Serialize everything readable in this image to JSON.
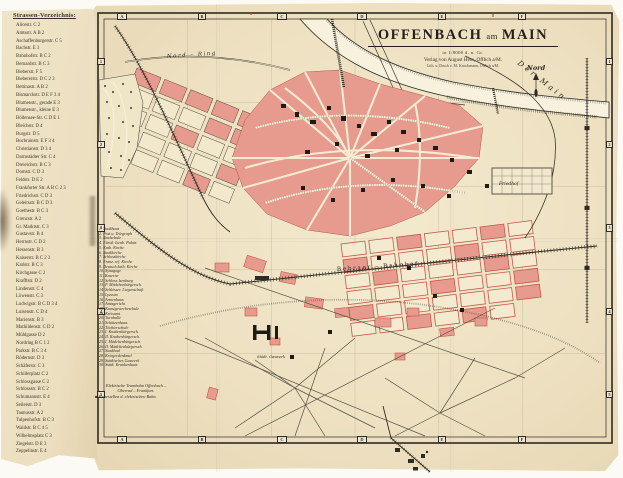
{
  "colors": {
    "paper": "#eee1c2",
    "map_ground": "#f3e9cd",
    "block_pink": "#e79a8e",
    "block_outline_red": "#c4584a",
    "ink": "#2e2a24",
    "river": "#f7f1dd"
  },
  "index": {
    "title": "Strassen-Verzeichnis:",
    "entries": [
      "Alicestr. C 2",
      "Amtsstr. A B 2",
      "Aschaffenburgerstr. C 5",
      "Bachstr. E 3",
      "Bahnhofstr. B C 2",
      "Bernardstr. B C 3",
      "Bieberstr. F 5",
      "Biebererstr. D C 2 3",
      "Bettinastr. A B 2",
      "Bismarckstr. D E F 3 4",
      "Blumenstr., gerade E 3",
      "Blumenstr., kleine E 3",
      "Böllensee-Str. C D E 1",
      "Bleichstr. D 4",
      "Burgstr. D 5",
      "Buchrainstr. E F 3 4",
      "Christianstr. D 3 4",
      "Darmstädter Str. C 4",
      "Dreieichstr. B C 3",
      "Domstr. C D 3",
      "Feldstr. D E 2",
      "Frankfurter Str. A B C 2 3",
      "Friedrichstr. C D 3",
      "Geleitsstr. B C D 3",
      "Goethestr. B C 3",
      "Grenzstr. A 2",
      "Gr. Marktstr. C 3",
      "Gustavstr. B 4",
      "Herrnstr. C D 2",
      "Hessenstr. B 3",
      "Kaiserstr. B C 2 3",
      "Karlstr. B C 3",
      "Kirchgasse C 2",
      "Krafftstr. D 2",
      "Lindenstr. C 4",
      "Löwenstr. C 3",
      "Ludwigstr. B C D 3 4",
      "Luisenstr. C D 4",
      "Marienstr. B 3",
      "Mathildenstr. C D 2",
      "Mühlgasse D 2",
      "Nordring B C 1 2",
      "Parkstr. B C 3 4",
      "Rödernstr. D 3",
      "Schäferstr. C 3",
      "Schillerplatz C 2",
      "Schlossgasse C 2",
      "Schlossstr. B C 2",
      "Schumannstr. E 4",
      "Seilerstr. D 3",
      "Taunusstr. A 2",
      "Tulpenhofstr. B C 3",
      "Waldstr. B C 4 5",
      "Wilhelmsplatz C 3",
      "Ziegelstr. D E 3",
      "Zeppelinstr. E 4"
    ]
  },
  "title_block": {
    "name_1": "OFFENBACH",
    "connector": "am",
    "name_2": "MAIN",
    "scale": "in 1/8000 d. n. Gr.",
    "publisher": "Verlag von August Hess, Offbch a/M.",
    "printer": "Lith. u. Druck v. M. Knochmann, Offbch a/M."
  },
  "north_label": "Nord",
  "grid": {
    "letters": [
      "A",
      "B",
      "C",
      "D",
      "E",
      "F"
    ],
    "numbers": [
      "1",
      "2",
      "3",
      "4",
      "5"
    ]
  },
  "legend": {
    "entries": [
      "1. Stadthaus",
      "2. Post u. Telegraph",
      "3. Realschule",
      "4. Fürstl. Isenb. Palais",
      "5. Kath. Kirche",
      "6. Stadtkirche",
      "7. Schlosskirche",
      "8. Franz. ref. Kirche",
      "9. Deutsch kath. Kirche",
      "10. Synagoge",
      "11. Kaserne",
      "12. Schloss Isenburg",
      "13. F. Mädchenbürgersch.",
      "14. Schlösser. Liegenschaft",
      "15. Lyzeum",
      "16. Armenhaus",
      "17. Amtsgericht",
      "18. Kunstgewerbeschule",
      "19. Kreisamt",
      "20. Turnhalle",
      "21. Schützenhaus",
      "22. Töchterschule",
      "23. I. Knabenbürgersch.",
      "24. II. Knabenbürgersch.",
      "25. I. Mädchenbürgersch.",
      "26. II. Mädchenbürgersch.",
      "27. Stadtbad",
      "28. Kriegerdenkmal",
      "29. Städtisches Gaswerk",
      "30. Städt. Krankenhaus"
    ]
  },
  "notes": {
    "bullet": "■",
    "line1": "Elektrische Trambahn Offenbach –",
    "line2": "Oberrad – Frankfurt.",
    "line3": "Haltestellen d. elektrischen Bahn."
  },
  "map_labels": {
    "nord_ring": "Nord – Ring",
    "river": "Der Main",
    "bebraer": "Bebraer – Bahnhof",
    "friedhof": "Friedhof",
    "gaswerk": "Städt. Gaswerk"
  }
}
